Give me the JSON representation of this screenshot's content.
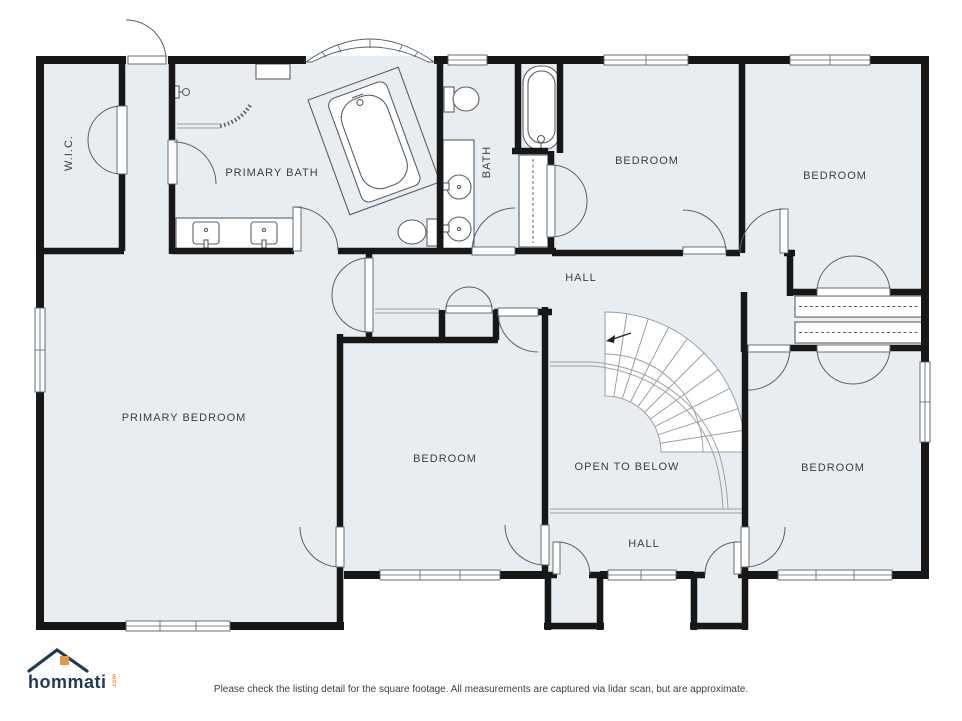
{
  "meta": {
    "type": "second-floor-plan"
  },
  "palette": {
    "floor": "#e8edf1",
    "wall": "#171717",
    "line_light": "#9aa0a5",
    "line_dark": "#5a6066",
    "label": "#3a3f44",
    "logo_navy": "#1d3a5a",
    "logo_orange": "#e8973a",
    "background": "#ffffff"
  },
  "rooms": [
    {
      "id": "wic",
      "label": "W.I.C."
    },
    {
      "id": "primary-bath",
      "label": "PRIMARY BATH"
    },
    {
      "id": "bath",
      "label": "BATH"
    },
    {
      "id": "bedroom-top-middle",
      "label": "BEDROOM"
    },
    {
      "id": "bedroom-top-right",
      "label": "BEDROOM"
    },
    {
      "id": "hall-upper",
      "label": "HALL"
    },
    {
      "id": "primary-bedroom",
      "label": "PRIMARY BEDROOM"
    },
    {
      "id": "bedroom-middle",
      "label": "BEDROOM"
    },
    {
      "id": "open-to-below",
      "label": "OPEN TO BELOW"
    },
    {
      "id": "bedroom-bottom-right",
      "label": "BEDROOM"
    },
    {
      "id": "hall-lower",
      "label": "HALL"
    }
  ],
  "fixtures": [
    "bathtub-platform",
    "freestanding-tub",
    "shower",
    "toilet",
    "toilet",
    "double-sink-vanity",
    "double-round-sink-vanity",
    "bench",
    "linen-closet-rod",
    "closet-rod",
    "closet-rod",
    "curved-staircase",
    "stair-direction-arrow",
    "bay-window"
  ],
  "branding": {
    "logo_text": "hommati",
    "logo_suffix": ".com"
  },
  "footer": {
    "disclaimer": "Please check the listing detail for the square footage. All measurements are captured via lidar scan, but are approximate."
  }
}
